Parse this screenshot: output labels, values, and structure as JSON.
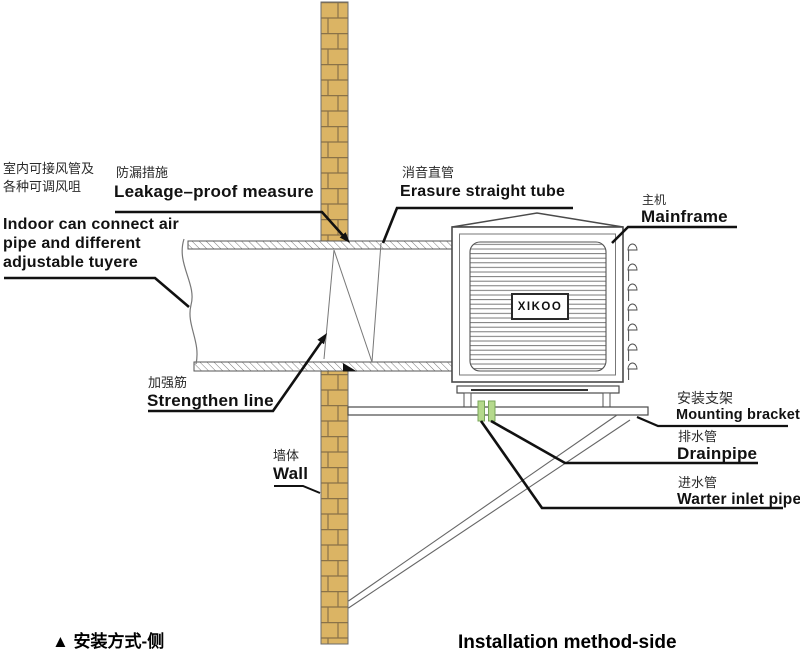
{
  "diagram_title": {
    "footer_left": "▲ 安装方式-侧",
    "footer_right": "Installation method-side"
  },
  "brand": {
    "logo": "XIKOO"
  },
  "labels": {
    "indoor": {
      "zh_line1": "室内可接风管及",
      "zh_line2": "各种可调风咀",
      "en_line1": "Indoor can connect air",
      "en_line2": "pipe and different",
      "en_line3": "adjustable tuyere"
    },
    "leakage": {
      "zh": "防漏措施",
      "en": "Leakage–proof measure"
    },
    "erasure": {
      "zh": "消音直管",
      "en": "Erasure straight tube"
    },
    "mainframe": {
      "zh": "主机",
      "en": "Mainframe"
    },
    "strengthen": {
      "zh": "加强筋",
      "en": "Strengthen line"
    },
    "wall": {
      "zh": "墙体",
      "en": "Wall"
    },
    "bracket": {
      "zh": "安装支架",
      "en": "Mounting bracket"
    },
    "drainpipe": {
      "zh": "排水管",
      "en": "Drainpipe"
    },
    "water_inlet": {
      "zh": "进水管",
      "en": "Warter inlet pipe"
    }
  },
  "colors": {
    "brick_fill": "#DBB464",
    "brick_joint": "#8A7248",
    "pipe_green": "#B5D98C",
    "line_gray": "#4A4A4A",
    "leader_black": "#111111"
  }
}
